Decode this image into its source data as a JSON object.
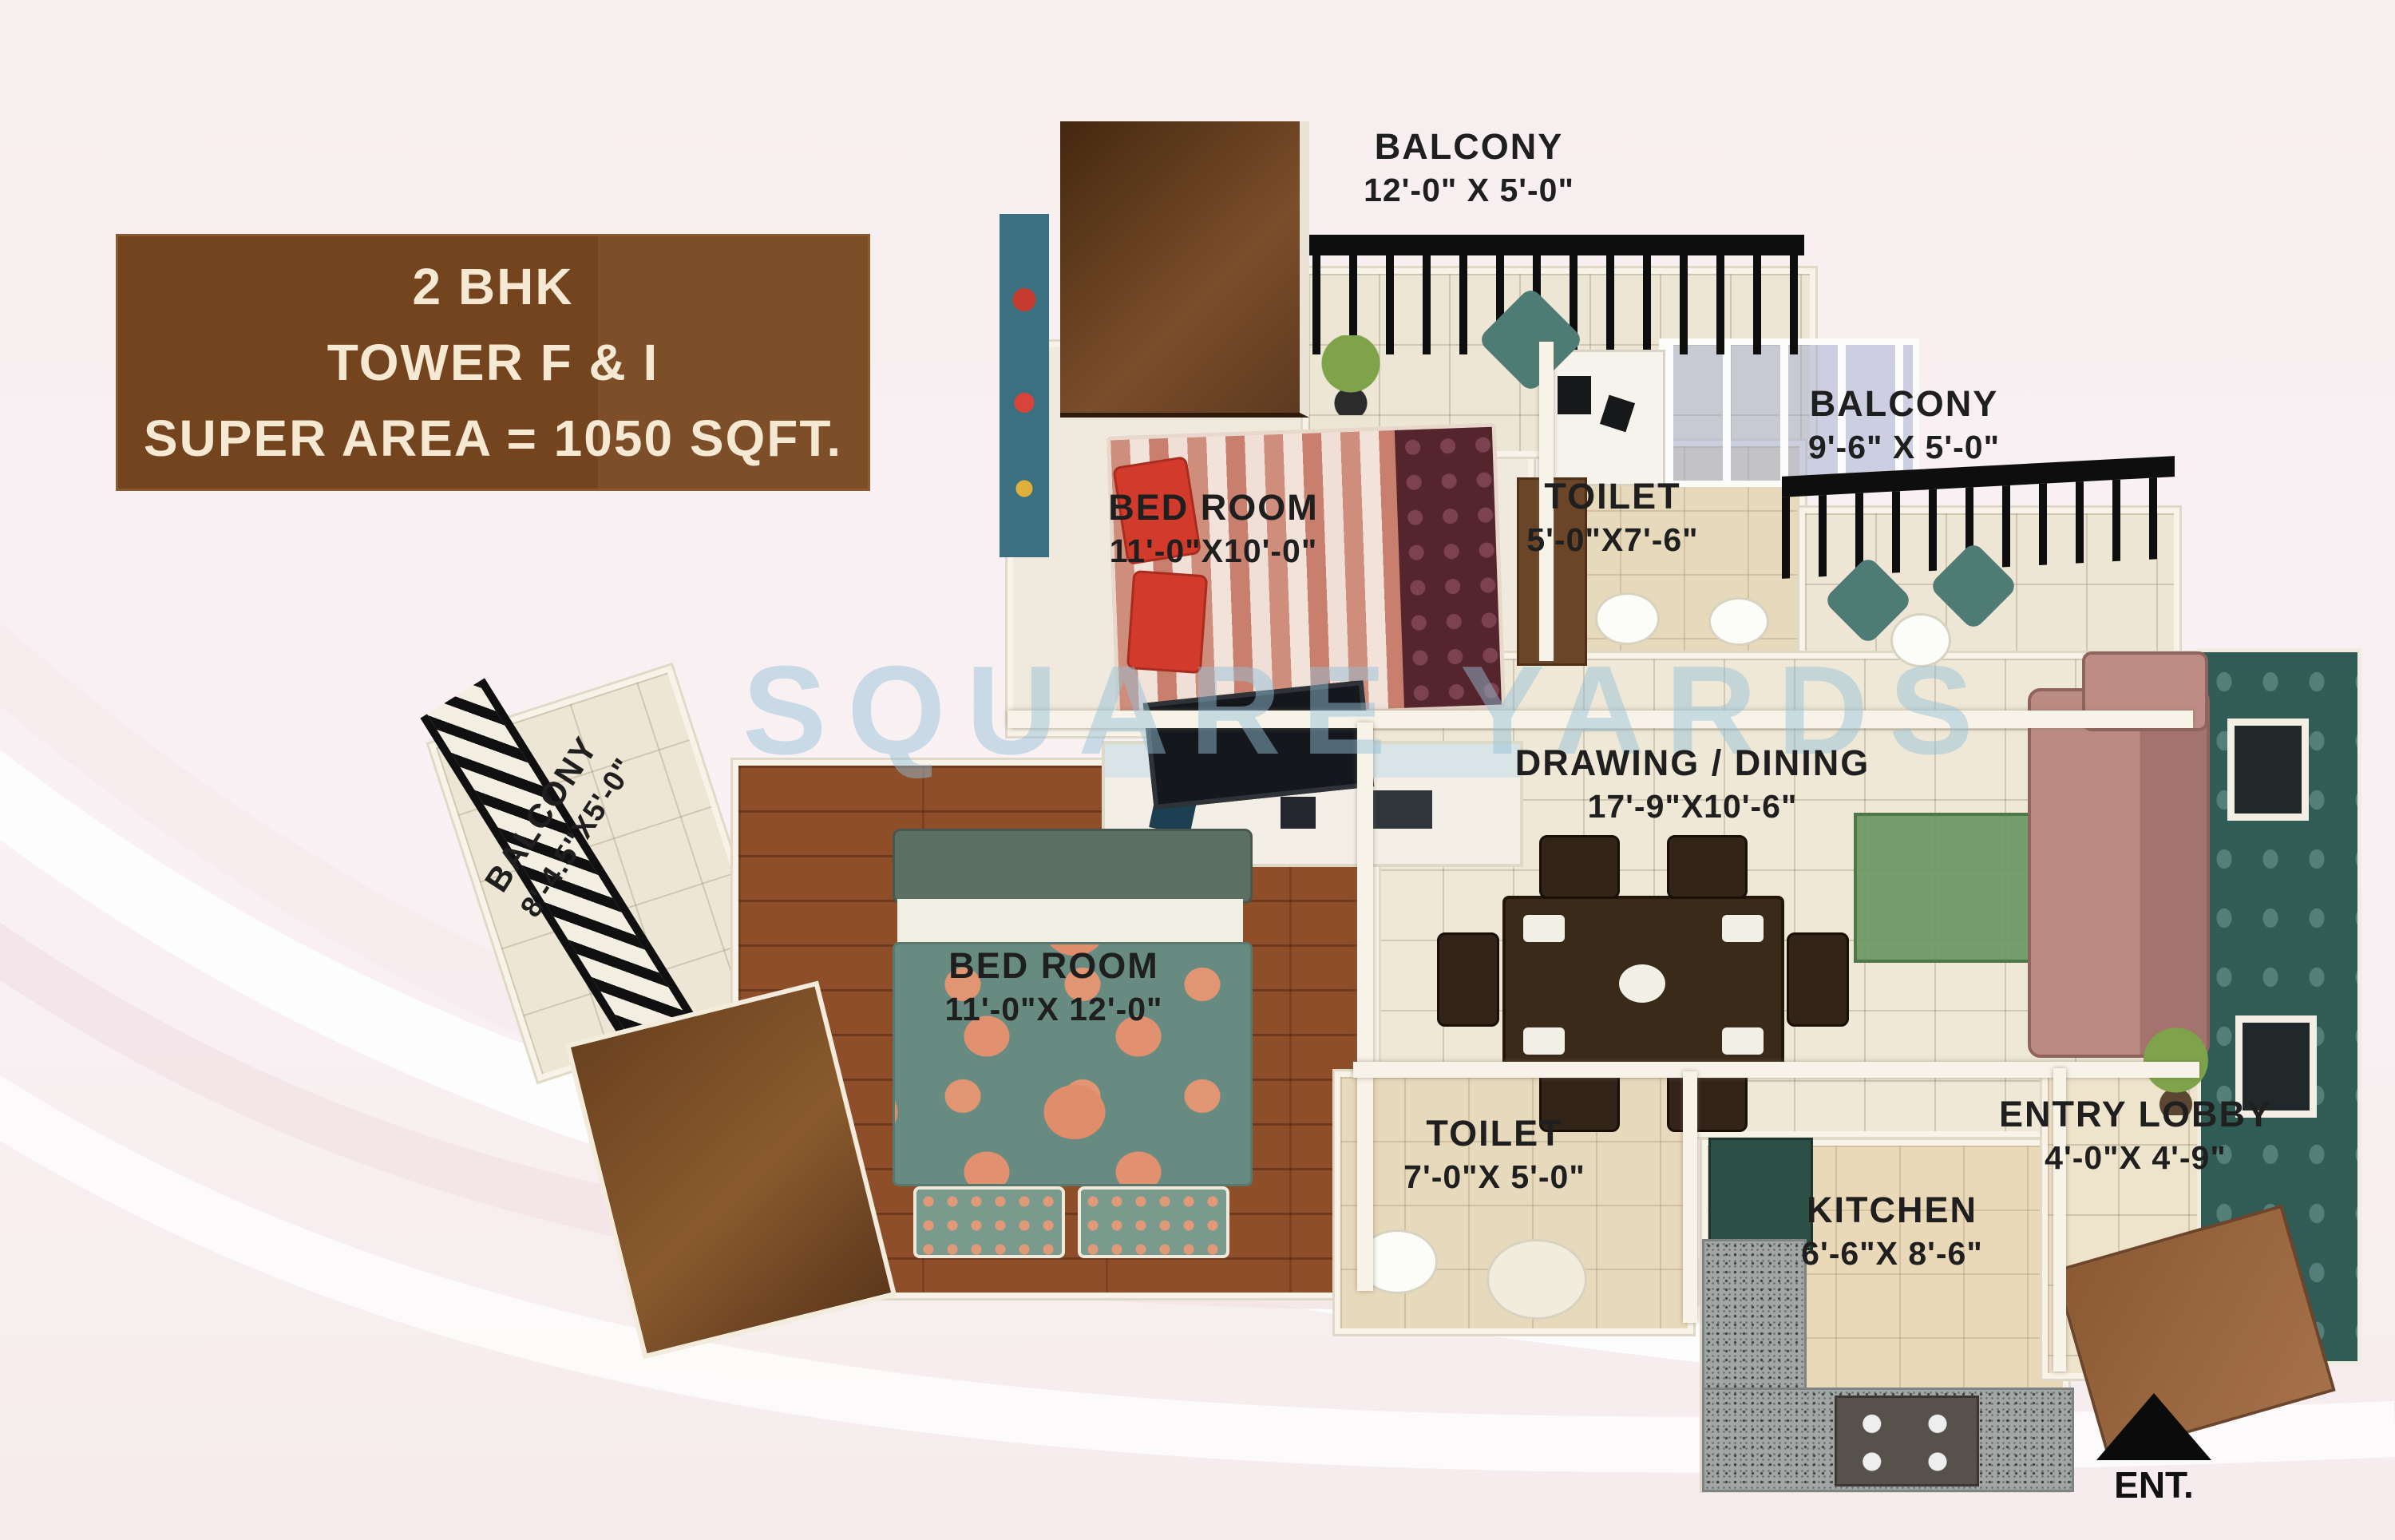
{
  "title_box": {
    "lines": [
      "2 BHK",
      "TOWER F & I",
      "SUPER AREA = 1050 SQFT."
    ]
  },
  "watermark": {
    "text": "SQUARE YARDS"
  },
  "rooms": {
    "balcony_top": {
      "name": "BALCONY",
      "dims": "12'-0\" X 5'-0\""
    },
    "balcony_right": {
      "name": "BALCONY",
      "dims": "9'-6\" X 5'-0\""
    },
    "balcony_left": {
      "name": "BALCONY",
      "dims": "8'-4.5\"X5'-0\""
    },
    "bedroom_top": {
      "name": "BED ROOM",
      "dims": "11'-0\"X10'-0\""
    },
    "toilet_top": {
      "name": "TOILET",
      "dims": "5'-0\"X7'-6\""
    },
    "drawing_dining": {
      "name": "DRAWING / DINING",
      "dims": "17'-9\"X10'-6\""
    },
    "bedroom_left": {
      "name": "BED ROOM",
      "dims": "11'-0\"X 12'-0\""
    },
    "toilet_bottom": {
      "name": "TOILET",
      "dims": "7'-0\"X 5'-0\""
    },
    "kitchen": {
      "name": "KITCHEN",
      "dims": "6'-6\"X 8'-6\""
    },
    "entry_lobby": {
      "name": "ENTRY LOBBY",
      "dims": "4'-0\"X 4'-9\""
    }
  },
  "entrance": {
    "label": "ENT."
  },
  "palette": {
    "title_bg": "#7a4a25",
    "title_text": "#f5e9d3",
    "watermark_blue": "#94c0d8",
    "accent_wall_teal": "#305c55",
    "wood_floor": "#8d4e29",
    "tile_floor": "#eee6d4",
    "railing_black": "#0e0e0e",
    "sofa_mauve": "#b28079",
    "bed_blanket_teal": "#678b80",
    "background_pink": "#f8f0f2",
    "label_text": "#1f1f1f"
  }
}
